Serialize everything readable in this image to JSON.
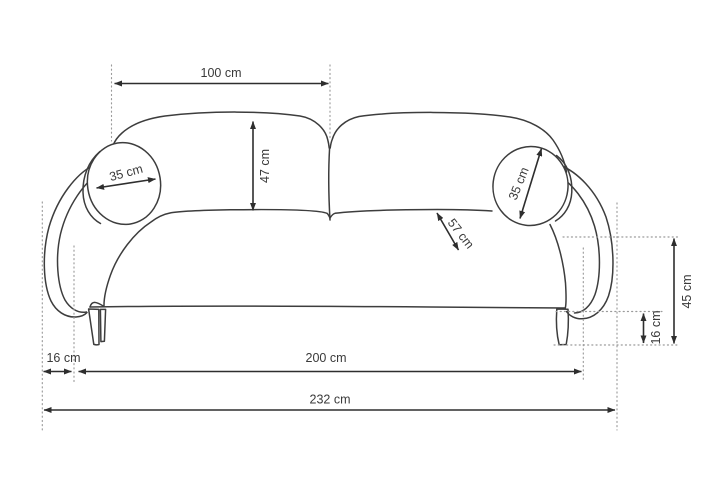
{
  "diagram": {
    "unit": "cm",
    "colors": {
      "outline": "#3d3d3d",
      "dimension": "#2e2e2e",
      "guide": "#9b9b9b",
      "label_text": "#3a3a3a",
      "background": "#ffffff"
    },
    "labels": {
      "back_width": "100 cm",
      "back_cushion_height": "47 cm",
      "pillow_left_diameter": "35 cm",
      "pillow_right_diameter": "35 cm",
      "seat_depth": "57 cm",
      "seat_height": "45 cm",
      "leg_height": "16 cm",
      "armrest_width": "16 cm",
      "seat_width": "200 cm",
      "total_width": "232 cm"
    }
  }
}
